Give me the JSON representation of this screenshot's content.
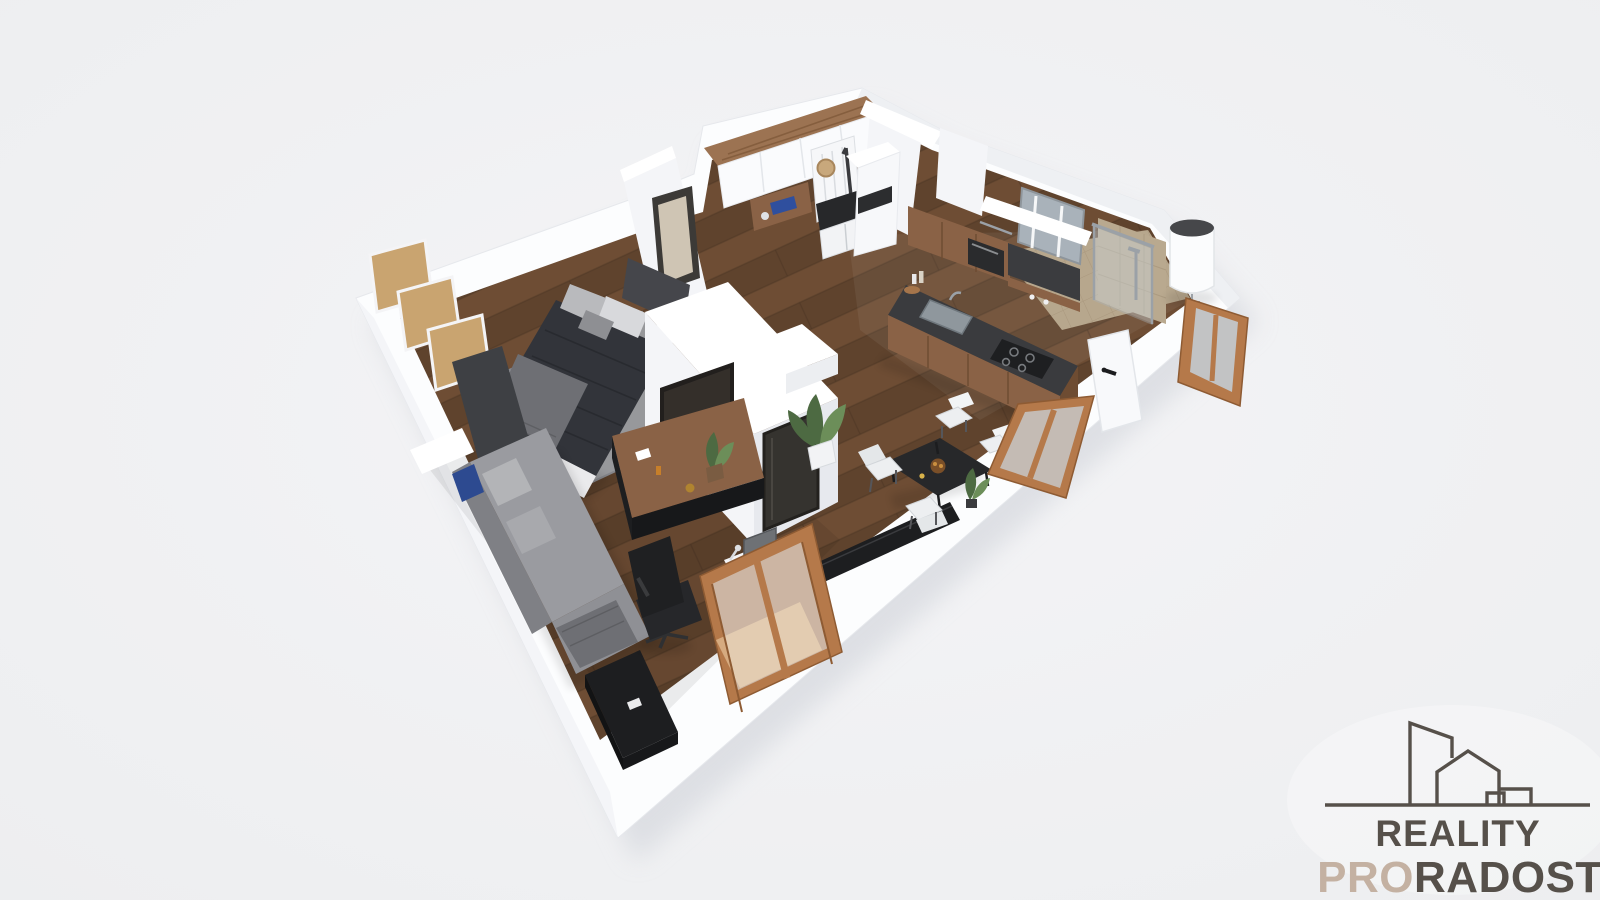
{
  "canvas": {
    "width": 1600,
    "height": 900
  },
  "colors": {
    "background": "#eff0f2",
    "shadow": "#d5d8de",
    "wall_white": "#fcfdfe",
    "wall_top": "#ffffff",
    "wall_edge": "#e6e8ec",
    "wall_face_light": "#f4f5f8",
    "wall_face_shade": "#e7e9ee",
    "wall_ne_shade": "#eef0f3",
    "floor_wood": "#6e4d34",
    "floor_wood_dark": "#5f432d",
    "plank_seam": "#4b3523",
    "tile": "#b7a78d",
    "tile_grout": "#a6957b",
    "rug": "#97989b",
    "rug_edge": "#85868b",
    "bed_duvet": "#32343a",
    "bed_sheet": "#eaeaec",
    "bed_pillow": "#d8d9dc",
    "headboard": "#45464b",
    "sofa": "#9a9ba0",
    "sofa_back": "#7f8085",
    "sofa_chaise": "#8f9095",
    "blanket": "#6e6f74",
    "pillow_blue": "#2d4a90",
    "black_furniture": "#1d1e20",
    "chair_black": "#26272a",
    "wood_cab": "#8a6246",
    "wood_cab_dark": "#6e4c32",
    "wood_top": "#9c7352",
    "wood_grain": "#7c5636",
    "counter": "#3a3b3e",
    "dark_run": "#3b3c3f",
    "steel": "#9ba1a7",
    "glass": "#cfdde6",
    "window_wood": "#b5794a",
    "window_wood_dark": "#8e5b33",
    "white_furniture": "#f6f7f9",
    "white_chair": "#edeff1",
    "plant": "#4d6a42",
    "plant_light": "#6c8e59",
    "cork": "#c9a470",
    "panel_dark": "#3e4044",
    "mirror_glass": "#a9b2ba",
    "tan_wall": "#b9a98f",
    "tv_screen": "#221f1d",
    "heater_top": "#46474a",
    "picture_frame": "#3c3a37",
    "picture_art": "#cfc5b4",
    "logo_dark": "#56504a",
    "logo_accent": "#c4b1a2"
  },
  "logo": {
    "line1": "REALITY",
    "line2_accent": "PRO",
    "line2_rest": "RADOST",
    "icon": "buildings-skyline-icon"
  },
  "scene": {
    "kind": "3d-apartment-floor-plan-render",
    "rooms": [
      "bedroom",
      "living-room",
      "kitchen",
      "dining-area",
      "bathroom",
      "entry-hall"
    ],
    "objects": [
      "double-bed",
      "open-shelf-wardrobe",
      "wardrobe-side-panel",
      "wall-picture",
      "area-rug",
      "corner-sofa",
      "blue-pillow",
      "office-chair",
      "work-desk",
      "living-window-desk",
      "tv-partition-wall",
      "tv-screen",
      "hall-mirror",
      "wooden-sideboard",
      "potted-plant",
      "entry-wardrobe",
      "coat-rack",
      "straw-hat",
      "umbrella",
      "entry-bench",
      "tall-kitchen-cabinet",
      "kitchen-upper-cabinets",
      "microwave",
      "kitchen-counter",
      "kitchen-sink",
      "gas-hob",
      "bathroom-mirror",
      "shower-enclosure",
      "water-heater",
      "entrance-door",
      "door-handle",
      "dining-table",
      "fruit-bowl",
      "dining-chairs",
      "black-console",
      "living-window",
      "dining-window",
      "side-window"
    ]
  }
}
